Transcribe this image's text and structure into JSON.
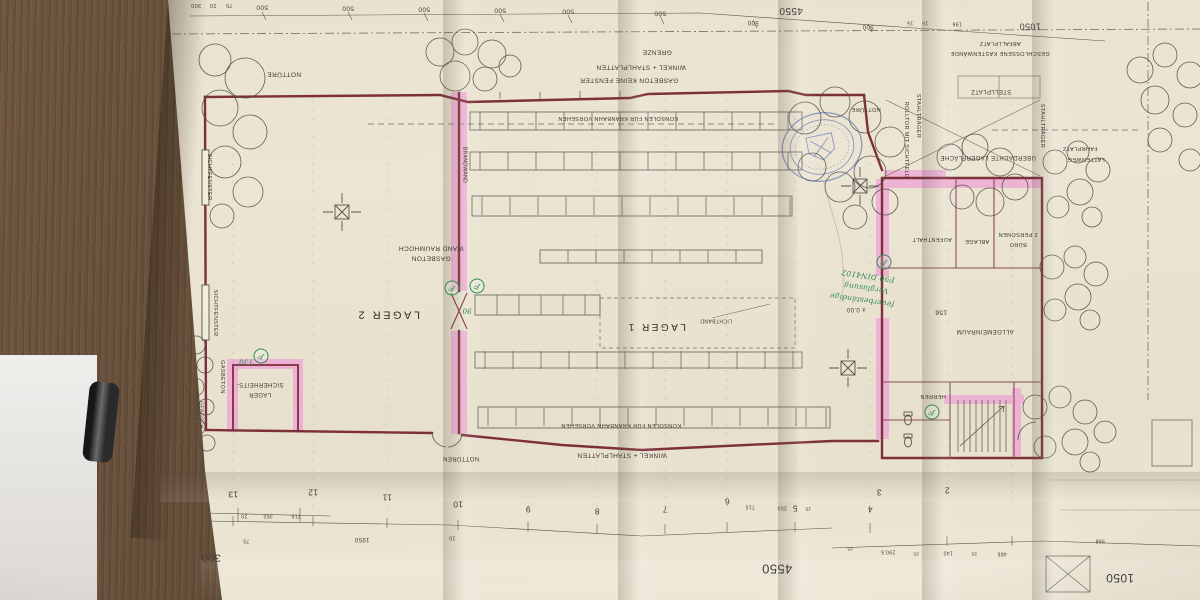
{
  "scene": {
    "description": "folded architectural floor plan photographed upside-down on a dark wooden table",
    "side_object": "dark bottle at left edge"
  },
  "colors": {
    "paper": "#ece5d4",
    "wall_red": "#7d2f3a",
    "highlight_pink": "#efa0d6",
    "stamp_blue": "#4c66ae",
    "handwriting_green": "#2f8a50",
    "wood": "#5c4732"
  },
  "labels": {
    "lager2": "LAGER 2",
    "lager1": "LAGER 1",
    "sicherheits_1": "SICHERHEITS-",
    "sicherheits_2": "LAGER",
    "allgemeinraum": "ALLGEMEINRAUM",
    "level156": "156",
    "level000": "± 0.00",
    "buero_1": "2 PERSONEN",
    "buero_2": "BÜRO",
    "ablage": "ABLAGE",
    "aufenthalt": "AUFENTHALT",
    "herren": "HERREN",
    "nottuere": "NOTTÜRE",
    "nottueren": "NOTTÜREN",
    "grenze": "GRENZE",
    "winkel_stahlplatten": "WINKEL + STAHLPLATTEN",
    "gasbeton_keine_fenster": "GASBETON   KEINE FENSTER",
    "konsolen": "KONSOLEN FÜR KRANBAHN VORSEHEN",
    "wand_raumhoch": "WAND  RAUMHOCH",
    "gasbeton_wort": "GASBETON",
    "brandwand": "BRANDWAND",
    "sichtfenster": "SICHTFENSTER",
    "rolltor": "ROLLTOR MIT SICHTFELD",
    "stahltraeger": "STAHLTRÄGER",
    "stellplatz": "STELLPLATZ",
    "ueberdachte": "ÜBERDACHTE LAGERFLÄCHE",
    "abfallplatz": "ABFALLPLATZ",
    "geschlossene": "GESCHLOSSENE KASTENWÄNDE",
    "fahrplatz": "FAHRPLATZ",
    "lattenweg": "LATTENWEG",
    "lichtband": "LICHTBAND",
    "gebuesch": "GEBÜSCH"
  },
  "handwritten": {
    "line_top": "F90 DIN4102",
    "line_mid": "Verglasung",
    "line_bottom": "feuerbeständige",
    "t30": "T30",
    "t90": "90",
    "f": "F"
  },
  "dims": {
    "d500": "500",
    "d4550": "4550",
    "d1050": "1050",
    "d300": "300",
    "d1950": "1950",
    "d350": "350",
    "d715": "715",
    "d250": "250",
    "d75": "75",
    "d20": "20",
    "d15": "15",
    "d196": "196",
    "d485": "485",
    "d998": "998",
    "d2905": "290.5",
    "d140": "140",
    "d25": "25"
  },
  "grid": [
    "13",
    "12",
    "11",
    "10",
    "9",
    "8",
    "7",
    "6",
    "5",
    "4",
    "3",
    "2"
  ]
}
